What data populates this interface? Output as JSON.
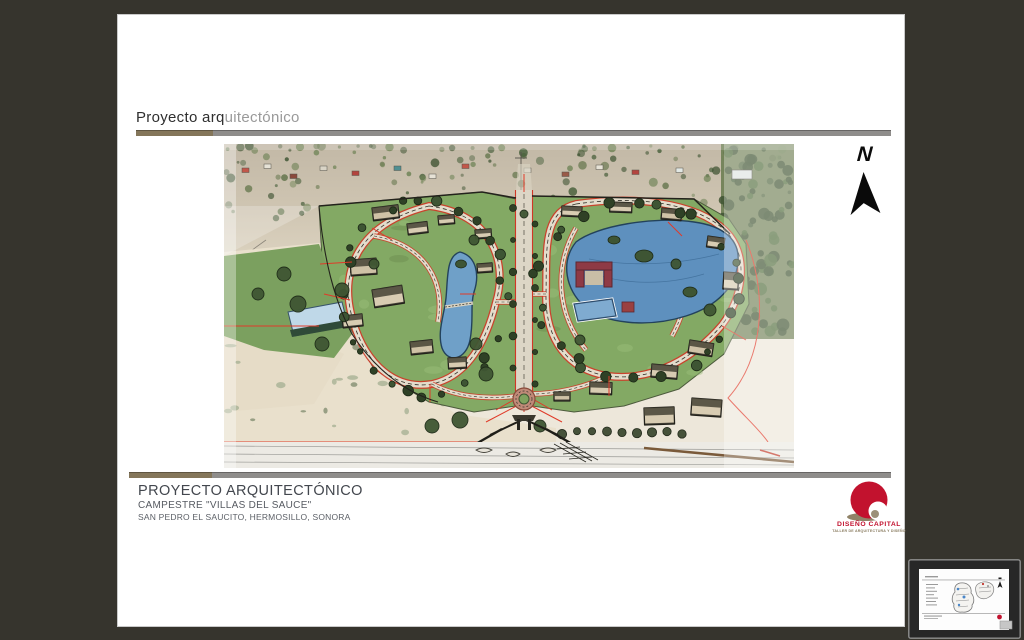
{
  "screen": {
    "background": "#36342D"
  },
  "slide": {
    "section_header": {
      "text_primary": "Proyecto arq",
      "text_secondary": "uitectónico"
    },
    "divider_colors": {
      "olive": "#84765A",
      "gray": "#8F8D8B"
    },
    "north_arrow": {
      "label": "N"
    },
    "rendering": {
      "description": "Hand-drawn aerial perspective rendering of the Campestre \"Villas del Sauce\" master plan — two looping residential clusters with lakes, clubhouse, pools, gardens and an entry gate — sketched over an aerial photograph of the desert site."
    },
    "footer": {
      "title": "PROYECTO ARQUITECTÓNICO",
      "subtitle": "CAMPESTRE \"VILLAS DEL SAUCE\"",
      "location": "SAN PEDRO EL SAUCITO, HERMOSILLO, SONORA"
    },
    "logo": {
      "name": "DISEÑO CAPITAL",
      "tagline": "TALLER DE ARQUITECTURA Y DISEÑO",
      "red": "#C2122E",
      "olive": "#8A7C60"
    }
  },
  "preview_thumbnail": {
    "description": "Miniature preview of the site-plan sheet of the same project",
    "accent_red": "#C2122E"
  }
}
